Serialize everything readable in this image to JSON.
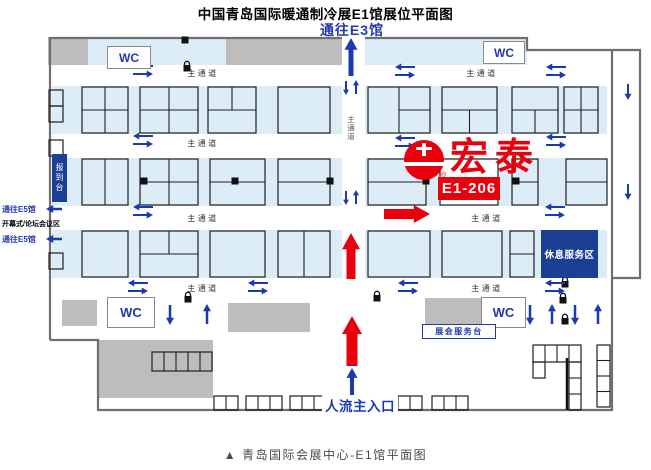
{
  "page": {
    "title": "中国青岛国际暖通制冷展E1馆展位平面图",
    "caption": "▲ 青岛国际会展中心-E1馆平面图"
  },
  "labels": {
    "to_e3": "通往E3馆",
    "to_e5": "通往E5馆",
    "opening_area": "开幕式/论坛会议区",
    "registration": "报到台",
    "rest_area": "休息服务区",
    "service_desk": "展会服务台",
    "main_entrance": "人流主入口",
    "wc": "WC",
    "aisle": "主通道"
  },
  "booth": {
    "id": "E1-206",
    "brand": "宏泰",
    "registered_mark": "®"
  },
  "colors": {
    "accent_red": "#e8000d",
    "arrow_blue": "#1c3ab0",
    "text_blue": "#2438ae",
    "navy_box": "#1c3e94",
    "band_blue": "#ddedf8",
    "wall_gray": "#6f6f6f",
    "block_gray": "#bdbdbd"
  },
  "map": {
    "bands": [
      [
        52,
        86,
        290,
        48
      ],
      [
        365,
        86,
        242,
        48
      ],
      [
        52,
        158,
        290,
        48
      ],
      [
        365,
        158,
        242,
        48
      ],
      [
        52,
        230,
        290,
        48
      ],
      [
        365,
        230,
        242,
        48
      ],
      [
        88,
        37,
        138,
        28
      ],
      [
        365,
        37,
        162,
        28
      ]
    ],
    "gray_blocks": [
      [
        48,
        37,
        40,
        28
      ],
      [
        226,
        37,
        116,
        28
      ],
      [
        62,
        300,
        35,
        26
      ],
      [
        228,
        303,
        82,
        29
      ],
      [
        425,
        298,
        57,
        28
      ],
      [
        98,
        340,
        115,
        58
      ]
    ],
    "walls": [
      "M50,340 L50,38 L342,38",
      "M365,38 L527,38 L527,50 L640,50 L640,278 L612,278 L612,410 L385,410",
      "M327,410 L98,410 L98,340 L50,340",
      "M612,50 L612,278"
    ],
    "thick_walls": [
      "M567,358 L567,410"
    ],
    "booths": [
      [
        82,
        87,
        46,
        46,
        "quad"
      ],
      [
        140,
        87,
        58,
        46,
        "quad"
      ],
      [
        208,
        87,
        48,
        46,
        "top2"
      ],
      [
        278,
        87,
        52,
        46,
        "plain"
      ],
      [
        368,
        87,
        62,
        46,
        "right2"
      ],
      [
        442,
        87,
        55,
        46,
        "bot2"
      ],
      [
        512,
        87,
        46,
        46,
        "bot2"
      ],
      [
        564,
        87,
        34,
        46,
        "quad"
      ],
      [
        82,
        159,
        46,
        46,
        "cols2"
      ],
      [
        140,
        159,
        58,
        46,
        "quad"
      ],
      [
        210,
        159,
        55,
        46,
        "rows2"
      ],
      [
        278,
        159,
        52,
        46,
        "rows2"
      ],
      [
        368,
        159,
        58,
        46,
        "rows2"
      ],
      [
        440,
        159,
        58,
        46,
        "hl"
      ],
      [
        512,
        159,
        26,
        46,
        "rows2"
      ],
      [
        566,
        159,
        41,
        46,
        "rows2"
      ],
      [
        82,
        231,
        46,
        46,
        "plain"
      ],
      [
        140,
        231,
        58,
        46,
        "top2"
      ],
      [
        210,
        231,
        55,
        46,
        "plain"
      ],
      [
        278,
        231,
        52,
        46,
        "cols2"
      ],
      [
        368,
        231,
        62,
        46,
        "plain"
      ],
      [
        442,
        231,
        60,
        46,
        "plain"
      ],
      [
        510,
        231,
        24,
        46,
        "rows2"
      ],
      [
        49,
        90,
        14,
        16,
        "plain"
      ],
      [
        49,
        106,
        14,
        16,
        "plain"
      ],
      [
        49,
        140,
        14,
        16,
        "plain"
      ],
      [
        49,
        253,
        14,
        16,
        "plain"
      ],
      [
        152,
        352,
        60,
        19,
        "cols5"
      ],
      [
        214,
        396,
        24,
        14,
        "cols2"
      ],
      [
        246,
        396,
        36,
        14,
        "cols3"
      ],
      [
        290,
        396,
        36,
        14,
        "cols3"
      ],
      [
        386,
        396,
        36,
        14,
        "cols3"
      ],
      [
        432,
        396,
        36,
        14,
        "cols3"
      ],
      [
        533,
        345,
        48,
        17,
        "cols4"
      ],
      [
        533,
        362,
        12,
        16,
        "plain"
      ],
      [
        569,
        362,
        12,
        48,
        "rows3"
      ],
      [
        597,
        345,
        13,
        62,
        "rows4"
      ]
    ],
    "pillars": [
      [
        185,
        40
      ],
      [
        144,
        181
      ],
      [
        235,
        181
      ],
      [
        330,
        181
      ],
      [
        426,
        181
      ],
      [
        516,
        181
      ]
    ],
    "gates": [
      [
        187,
        65
      ],
      [
        188,
        296
      ],
      [
        377,
        295
      ],
      [
        565,
        281
      ],
      [
        563,
        297
      ],
      [
        565,
        318
      ]
    ],
    "aisle_labels": [
      [
        203,
        76
      ],
      [
        482,
        76
      ],
      [
        203,
        146
      ],
      [
        203,
        221
      ],
      [
        487,
        221
      ],
      [
        203,
        291
      ],
      [
        487,
        291
      ]
    ],
    "aisle_label_vertical": [
      351,
      122
    ],
    "arrows": [
      [
        133,
        66,
        "L",
        20,
        2,
        7,
        "b"
      ],
      [
        153,
        74,
        "R",
        20,
        2,
        7,
        "b"
      ],
      [
        395,
        67,
        "L",
        20,
        2,
        7,
        "b"
      ],
      [
        415,
        75,
        "R",
        20,
        2,
        7,
        "b"
      ],
      [
        546,
        67,
        "L",
        20,
        2,
        7,
        "b"
      ],
      [
        566,
        75,
        "R",
        20,
        2,
        7,
        "b"
      ],
      [
        133,
        136,
        "L",
        20,
        2,
        7,
        "b"
      ],
      [
        153,
        144,
        "R",
        20,
        2,
        7,
        "b"
      ],
      [
        395,
        138,
        "L",
        20,
        2,
        7,
        "b"
      ],
      [
        415,
        146,
        "R",
        20,
        2,
        7,
        "b"
      ],
      [
        546,
        137,
        "L",
        20,
        2,
        7,
        "b"
      ],
      [
        566,
        145,
        "R",
        20,
        2,
        7,
        "b"
      ],
      [
        133,
        207,
        "L",
        20,
        2,
        7,
        "b"
      ],
      [
        153,
        215,
        "R",
        20,
        2,
        7,
        "b"
      ],
      [
        545,
        207,
        "L",
        20,
        2,
        7,
        "b"
      ],
      [
        565,
        215,
        "R",
        20,
        2,
        7,
        "b"
      ],
      [
        128,
        283,
        "L",
        20,
        2,
        7,
        "b"
      ],
      [
        148,
        291,
        "R",
        20,
        2,
        7,
        "b"
      ],
      [
        248,
        283,
        "L",
        20,
        2,
        7,
        "b"
      ],
      [
        268,
        291,
        "R",
        20,
        2,
        7,
        "b"
      ],
      [
        398,
        283,
        "L",
        20,
        2,
        7,
        "b"
      ],
      [
        418,
        291,
        "R",
        20,
        2,
        7,
        "b"
      ],
      [
        545,
        283,
        "L",
        20,
        2,
        7,
        "b"
      ],
      [
        565,
        291,
        "R",
        20,
        2,
        7,
        "b"
      ],
      [
        346,
        95,
        "D",
        14,
        2,
        6,
        "b"
      ],
      [
        356,
        80,
        "U",
        14,
        2,
        6,
        "b"
      ],
      [
        346,
        205,
        "D",
        14,
        2,
        6,
        "b"
      ],
      [
        356,
        190,
        "U",
        14,
        2,
        6,
        "b"
      ],
      [
        170,
        325,
        "D",
        20,
        2.5,
        8,
        "b"
      ],
      [
        207,
        304,
        "U",
        20,
        2.5,
        8,
        "b"
      ],
      [
        530,
        325,
        "D",
        20,
        2.5,
        8,
        "b"
      ],
      [
        552,
        304,
        "U",
        20,
        2.5,
        8,
        "b"
      ],
      [
        575,
        325,
        "D",
        20,
        2.5,
        8,
        "b"
      ],
      [
        598,
        304,
        "U",
        20,
        2.5,
        8,
        "b"
      ],
      [
        628,
        100,
        "D",
        16,
        2,
        7,
        "b"
      ],
      [
        628,
        200,
        "D",
        16,
        2,
        7,
        "b"
      ],
      [
        351,
        38,
        "U",
        38,
        5,
        13,
        "b"
      ],
      [
        352,
        368,
        "U",
        28,
        4,
        11,
        "b"
      ],
      [
        46,
        209,
        "L",
        16,
        2.5,
        8,
        "b"
      ],
      [
        46,
        239,
        "L",
        16,
        2.5,
        8,
        "b"
      ],
      [
        351,
        233,
        "U",
        46,
        9,
        18,
        "r"
      ],
      [
        352,
        316,
        "U",
        50,
        11,
        20,
        "r"
      ],
      [
        430,
        214,
        "R",
        46,
        10,
        18,
        "r"
      ]
    ]
  }
}
